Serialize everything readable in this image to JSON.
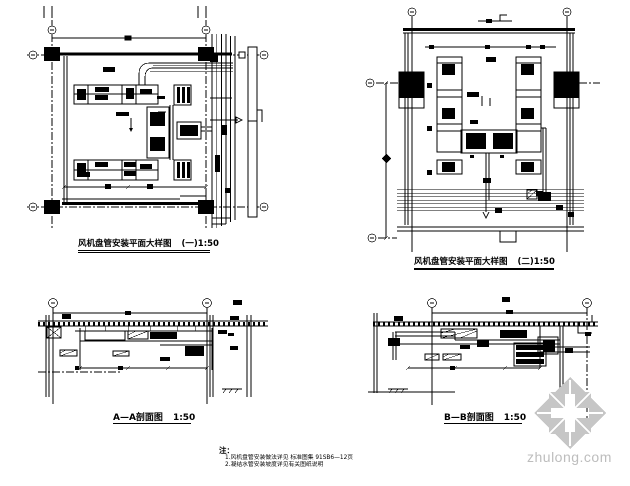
{
  "sheet": {
    "kind": "HVAC fan-coil installation detail drawing",
    "background_color": "#ffffff",
    "line_color": "#000000",
    "watermark_color": "#c6c6c6"
  },
  "drawings": {
    "plan1": {
      "title": "风机盘管安装平面大样图",
      "scale": "(一)1:50"
    },
    "plan2": {
      "title": "风机盘管安装平面大样图",
      "scale": "(二)1:50"
    },
    "sectionA": {
      "title": "A—A剖面图",
      "scale": "1:50"
    },
    "sectionB": {
      "title": "B—B剖面图",
      "scale": "1:50"
    }
  },
  "notes": {
    "heading": "注：",
    "items": [
      "1.风机盘管安装做法详见 标准图集 91SB6—12页",
      "2.凝结水管安装坡度详见有关图纸说明"
    ]
  },
  "watermark": {
    "text": "zhulong.com",
    "logo_icon": "pinwheel-logo"
  }
}
